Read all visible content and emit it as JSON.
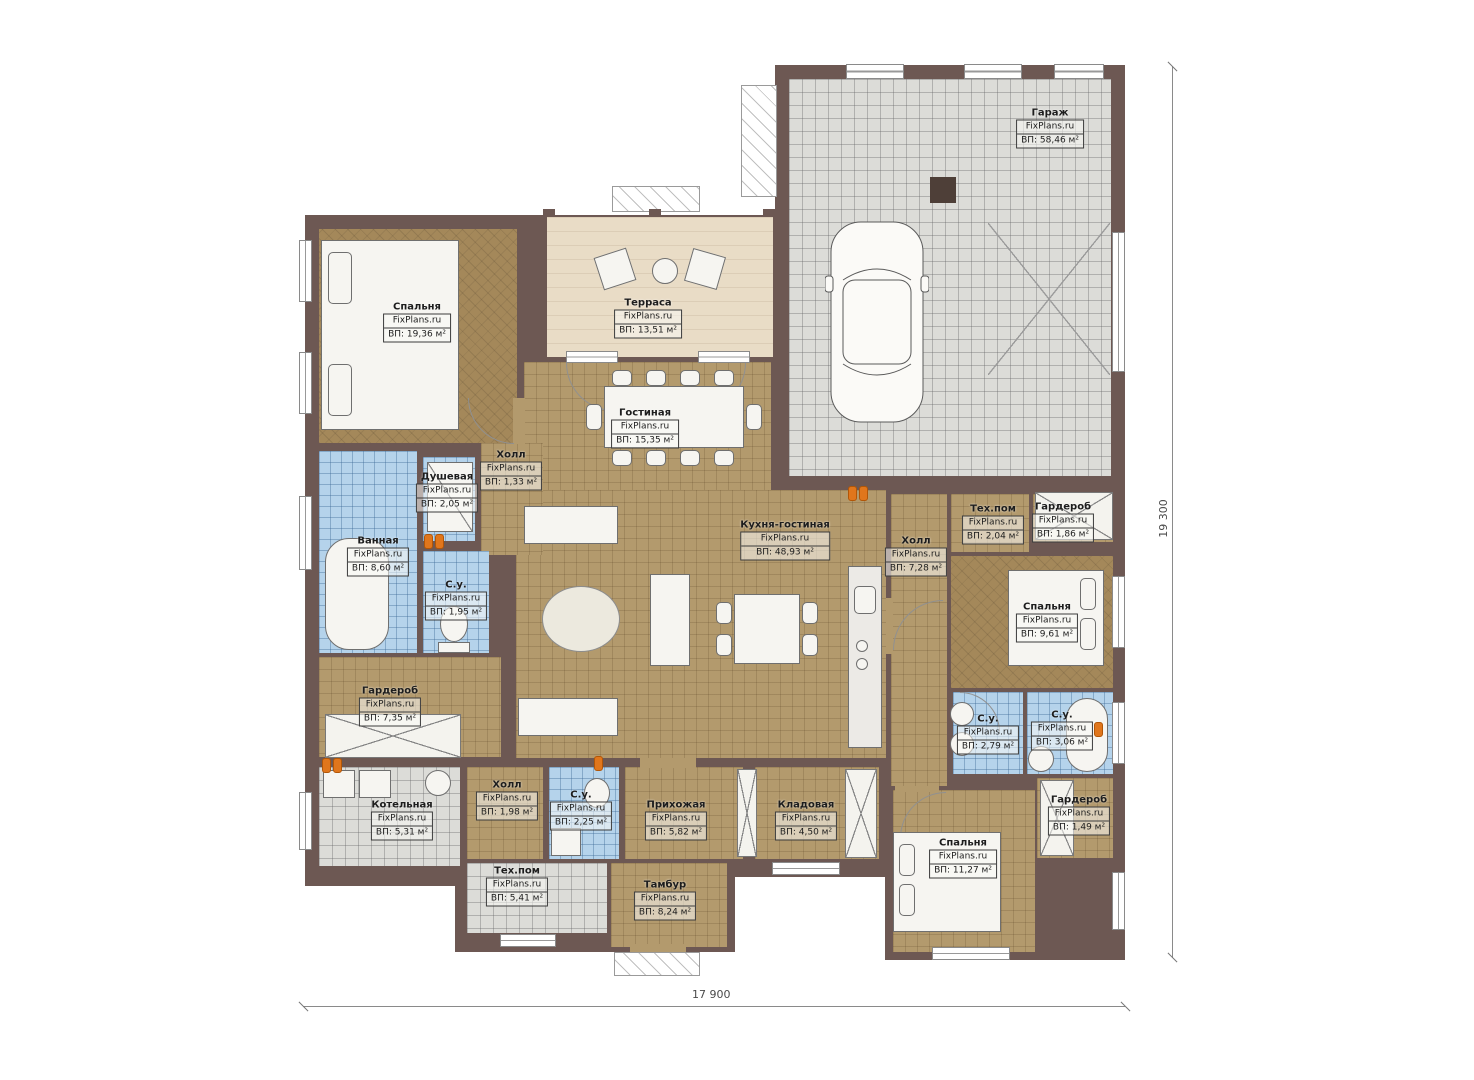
{
  "brand": "FixPlans.ru",
  "dimensions": {
    "bottom": "17 900",
    "right": "19 300"
  },
  "colors": {
    "wall": "#6d5853",
    "floor_wood": "#b39a6d",
    "floor_carpet": "#a4885a",
    "floor_tile_bath": "#b5d3eb",
    "floor_tile_tech": "#dcdcd8",
    "terrace": "#e9dcc6",
    "radiator": "#e0761c"
  },
  "rooms": [
    {
      "name": "Спальня",
      "area": "ВП: 19,36 м²"
    },
    {
      "name": "Терраса",
      "area": "ВП: 13,51 м²"
    },
    {
      "name": "Гараж",
      "area": "ВП: 58,46 м²"
    },
    {
      "name": "Гостиная",
      "area": "ВП: 15,35 м²"
    },
    {
      "name": "Холл",
      "area": "ВП: 1,33 м²"
    },
    {
      "name": "Душевая",
      "area": "ВП: 2,05 м²"
    },
    {
      "name": "Ванная",
      "area": "ВП: 8,60 м²"
    },
    {
      "name": "С.у.",
      "area": "ВП: 1,95 м²"
    },
    {
      "name": "Кухня-гостиная",
      "area": "ВП: 48,93 м²"
    },
    {
      "name": "Холл",
      "area": "ВП: 7,28 м²"
    },
    {
      "name": "Тех.пом",
      "area": "ВП: 2,04 м²"
    },
    {
      "name": "Гардероб",
      "area": "ВП: 1,86 м²"
    },
    {
      "name": "Спальня",
      "area": "ВП: 9,61 м²"
    },
    {
      "name": "Гардероб",
      "area": "ВП: 7,35 м²"
    },
    {
      "name": "С.у.",
      "area": "ВП: 2,79 м²"
    },
    {
      "name": "С.у.",
      "area": "ВП: 3,06 м²"
    },
    {
      "name": "Котельная",
      "area": "ВП: 5,31 м²"
    },
    {
      "name": "Холл",
      "area": "ВП: 1,98 м²"
    },
    {
      "name": "С.у.",
      "area": "ВП: 2,25 м²"
    },
    {
      "name": "Прихожая",
      "area": "ВП: 5,82 м²"
    },
    {
      "name": "Кладовая",
      "area": "ВП: 4,50 м²"
    },
    {
      "name": "Тех.пом",
      "area": "ВП: 5,41 м²"
    },
    {
      "name": "Тамбур",
      "area": "ВП: 8,24 м²"
    },
    {
      "name": "Спальня",
      "area": "ВП: 11,27 м²"
    },
    {
      "name": "Гардероб",
      "area": "ВП: 1,49 м²"
    }
  ]
}
